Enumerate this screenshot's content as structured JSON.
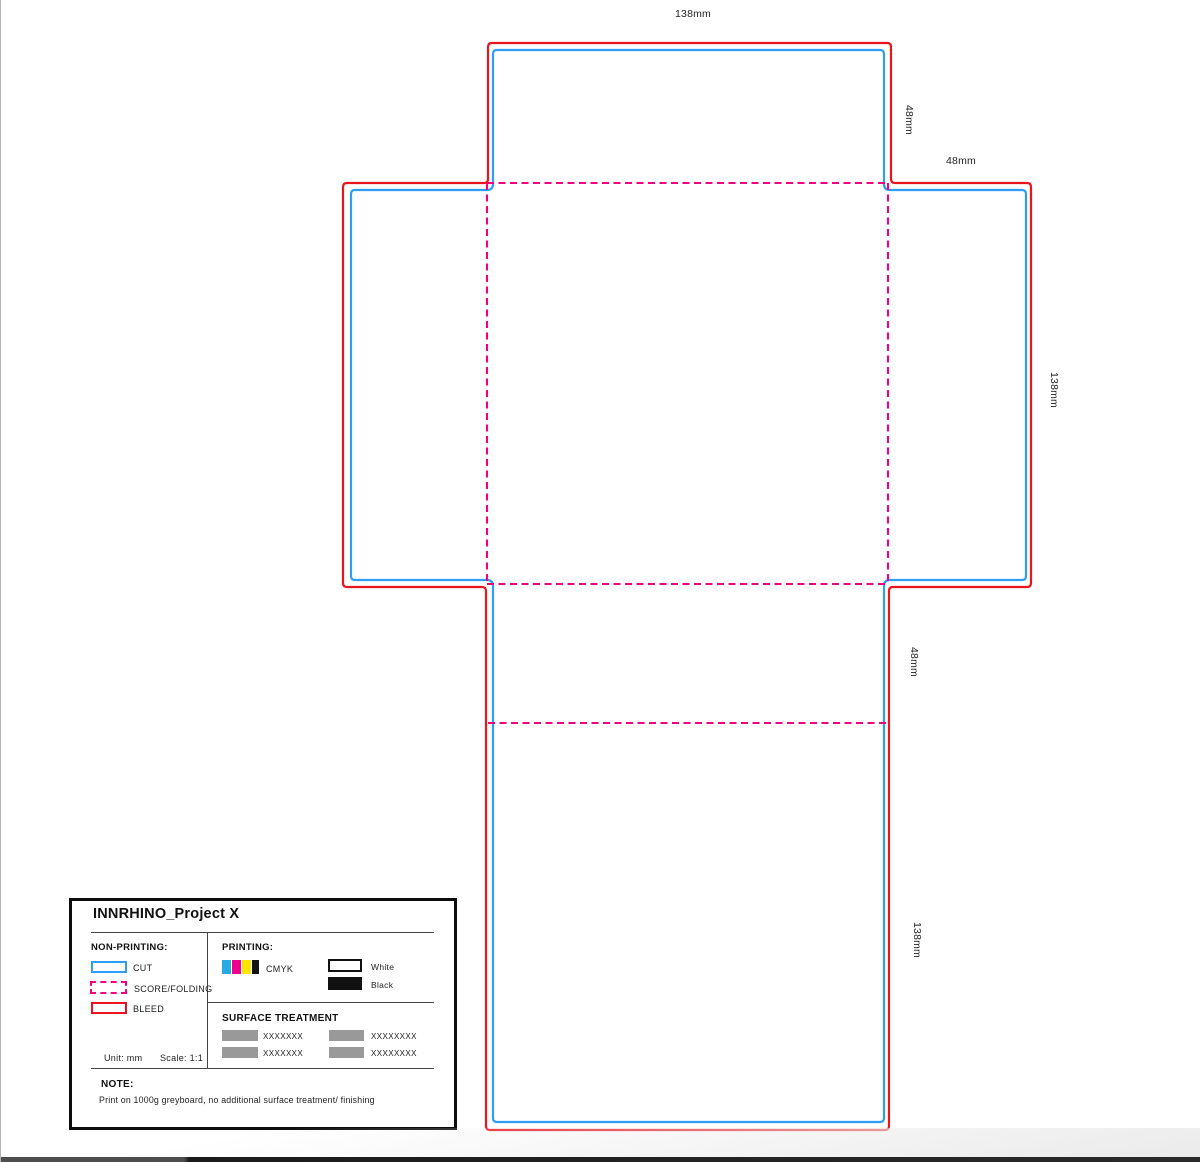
{
  "dieline": {
    "labels": {
      "top_width": "138mm",
      "top_flap_height": "48mm",
      "right_flap_width": "48mm",
      "right_panel_height": "138mm",
      "bottom_flap_height": "48mm",
      "bottom_panel_height": "138mm"
    }
  },
  "colors": {
    "cut": "#2e9df5",
    "score_folding": "#f20082",
    "bleed": "#e8141e",
    "cyan": "#29abe2",
    "magenta": "#ec008c",
    "yellow": "#ffe600",
    "black": "#141414",
    "swatch_gray": "#999999"
  },
  "legend": {
    "title": "INNRHINO_Project X",
    "non_printing": {
      "heading": "NON-PRINTING:",
      "items": [
        {
          "label": "CUT"
        },
        {
          "label": "SCORE/FOLDING"
        },
        {
          "label": "BLEED"
        }
      ]
    },
    "printing": {
      "heading": "PRINTING:",
      "cmyk_label": "CMYK",
      "white_label": "White",
      "black_label": "Black"
    },
    "surface_treatment": {
      "heading": "SURFACE TREATMENT",
      "items": [
        "XXXXXXX",
        "XXXXXXXX",
        "XXXXXXX",
        "XXXXXXXX"
      ]
    },
    "unit_label": "Unit: mm",
    "scale_label": "Scale: 1:1",
    "note_heading": "NOTE:",
    "note_text": "Print on 1000g greyboard, no additional surface treatment/ finishing"
  }
}
